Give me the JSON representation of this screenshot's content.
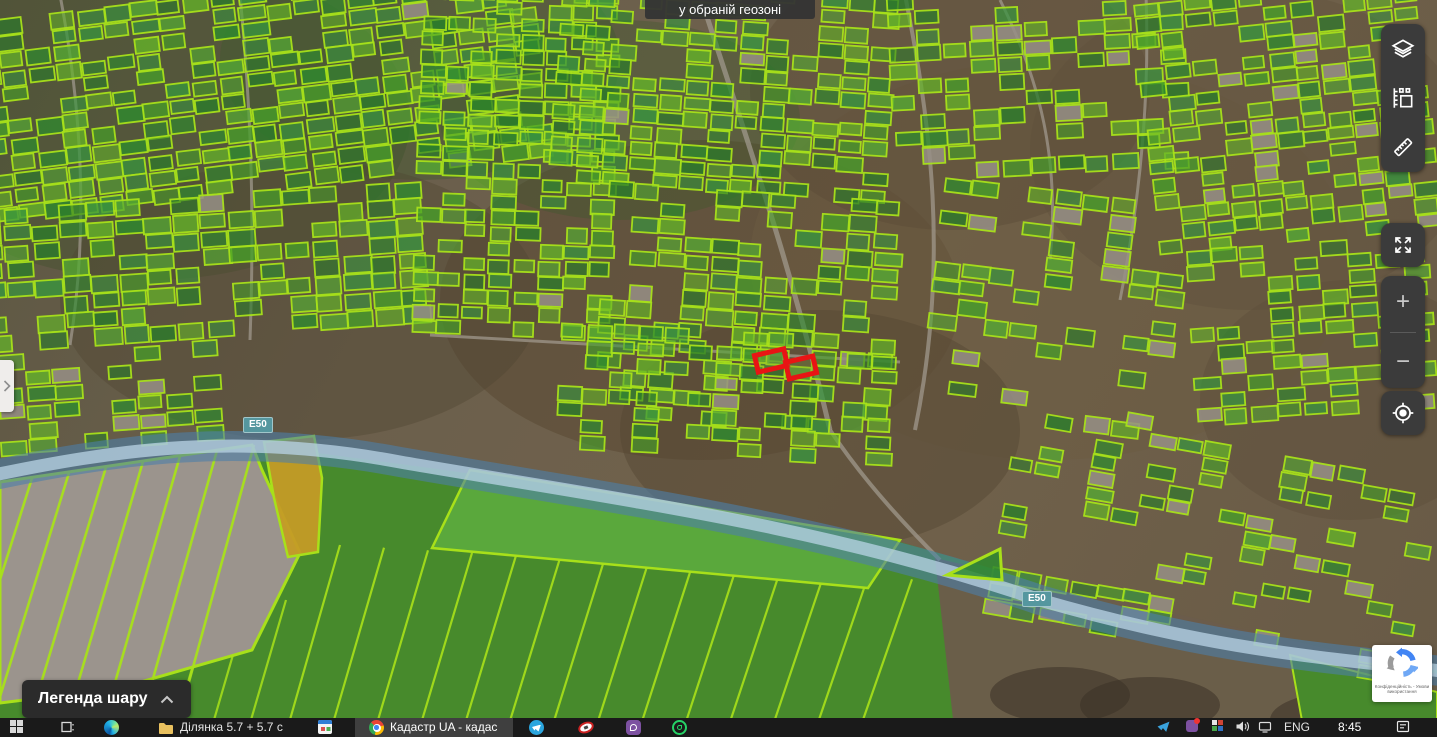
{
  "map_overlay": {
    "geozone_tooltip": "у обраній геозоні",
    "road_labels": {
      "west": "E50",
      "east": "E50"
    },
    "highlighted_parcels": [
      {
        "x": 756,
        "y": 352,
        "w": 30,
        "h": 17,
        "angle": -13
      },
      {
        "x": 787,
        "y": 359,
        "w": 28,
        "h": 17,
        "angle": -13
      }
    ]
  },
  "legend_panel": {
    "toggle_label": "Легенда шару"
  },
  "map_toolbar": {
    "zoom_in_label": "+",
    "zoom_out_label": "−"
  },
  "recaptcha_badge": {
    "line1": "Конфіденційність - Умови",
    "line2": "використання"
  },
  "taskbar": {
    "folder_item": "Ділянка 5.7 + 5.7 с",
    "active_window": "Кадастр UA - кадас",
    "tray": {
      "language": "ENG",
      "time": "8:45"
    }
  },
  "colors": {
    "parcel_stroke": "#a8e01a",
    "parcel_greens": [
      "#2e8c2e",
      "#46a028",
      "#64b428",
      "#38963e",
      "#2a7d2a",
      "#55aa33"
    ],
    "parcel_gray": "#968f86",
    "highlight_red": "#e81414",
    "highway_outer": "#4d7fa8",
    "highway_inner": "#b9d4e6",
    "road_label_bg": "#55979f",
    "field_green": "#478a2c",
    "field_light": "#5aa83c",
    "field_gray": "#9b948d",
    "field_yellow": "#c49b26",
    "ground_brown": "#6b5d4b"
  }
}
